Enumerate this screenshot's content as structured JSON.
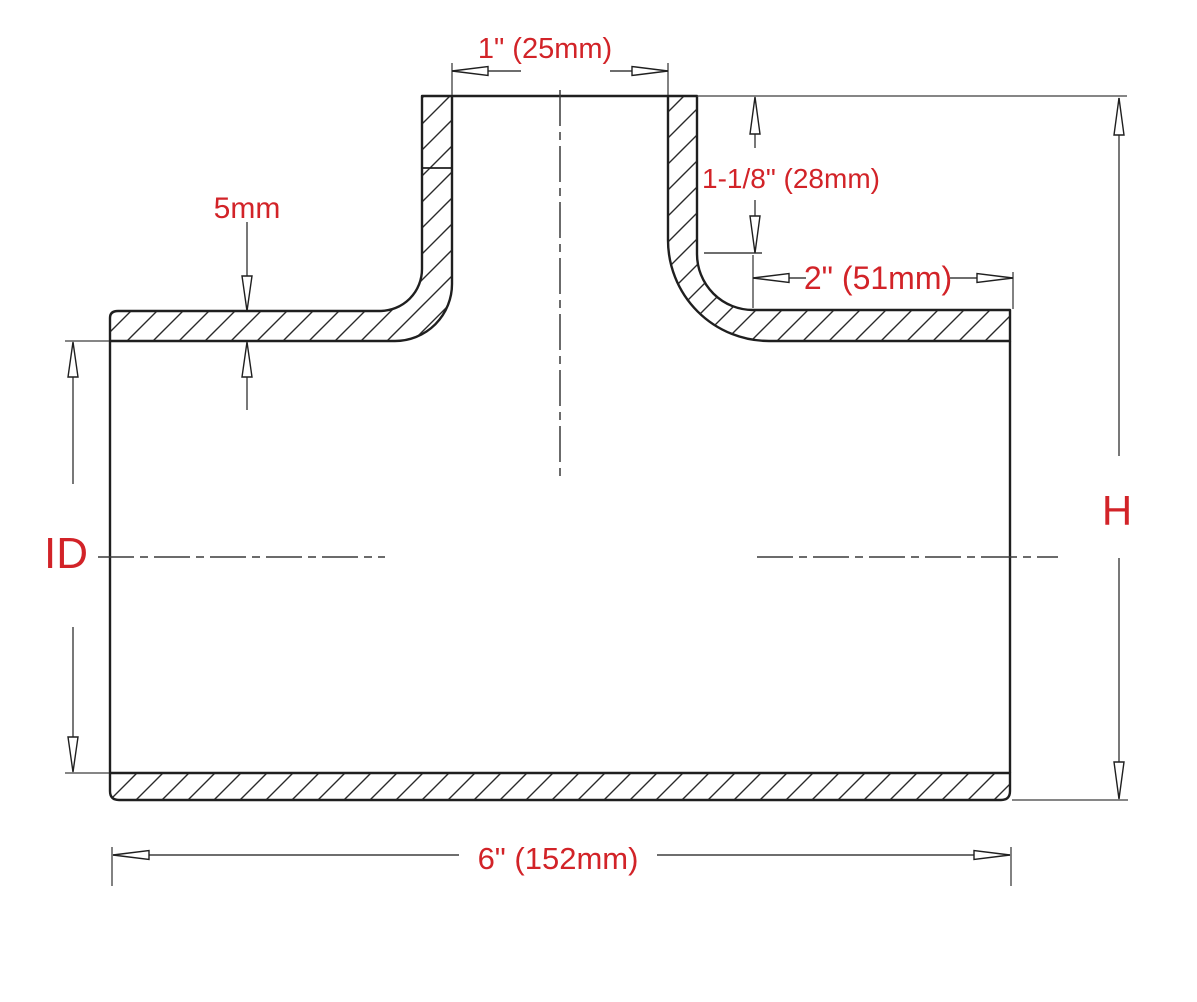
{
  "drawing": {
    "description_labels": {
      "branch_inner_diameter": "1\" (25mm)",
      "branch_stub_height": "1-1/8\" (28mm)",
      "wall_thickness": "5mm",
      "right_shoulder_length": "2\" (51mm)",
      "inner_diameter": "ID",
      "overall_height": "H",
      "overall_length": "6\" (152mm)"
    },
    "colors": {
      "dimension_text": "#d22328",
      "line": "#1f1f1f"
    }
  }
}
